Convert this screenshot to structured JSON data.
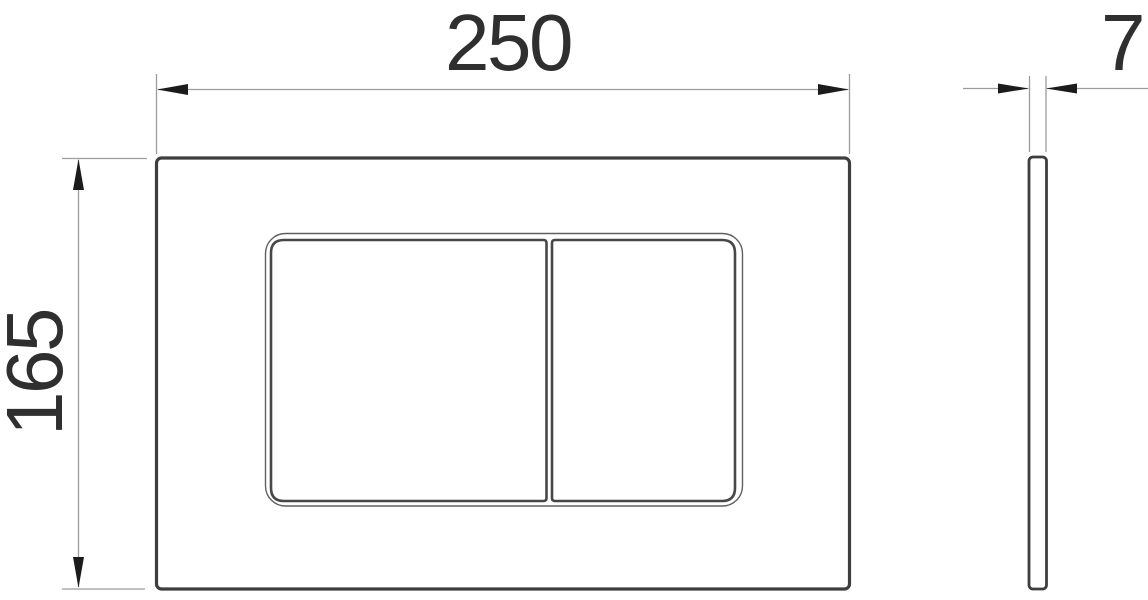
{
  "drawing": {
    "dimensions": {
      "width": "250",
      "height": "165",
      "thickness": "7"
    },
    "colors": {
      "background": "#ffffff",
      "object_line": "#3e3e3e",
      "thin_line": "#606060",
      "dimension_line": "#9c9c9c",
      "arrowhead": "#1b1b1b",
      "text": "#2f2f2f"
    }
  }
}
